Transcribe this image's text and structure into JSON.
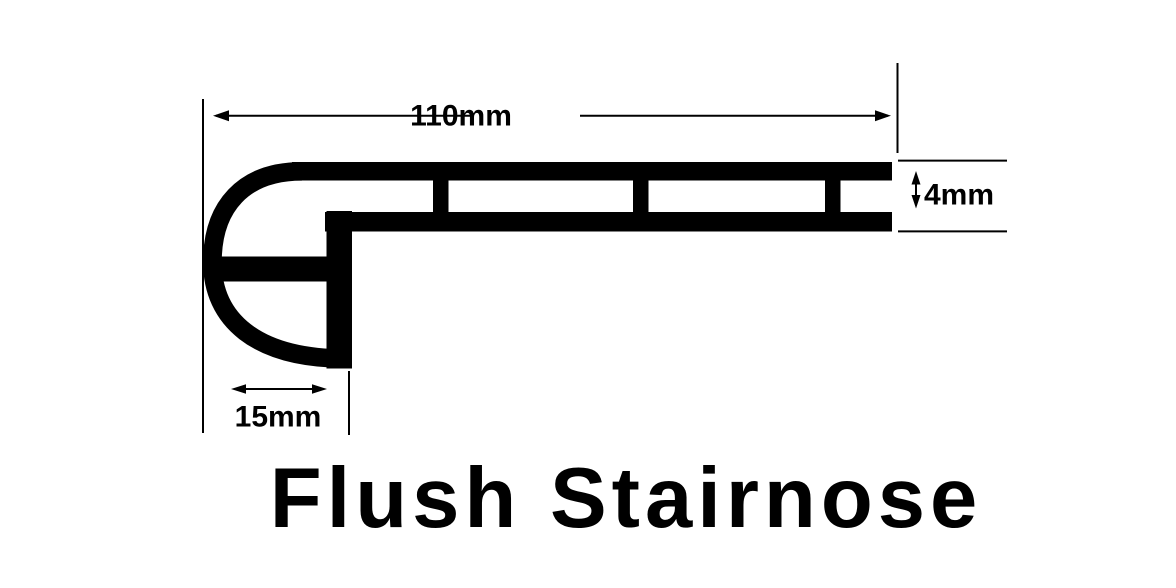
{
  "diagram": {
    "title": "Flush Stairnose",
    "ink_color": "#000000",
    "background_color": "#ffffff",
    "dimensions": {
      "width_label": "110mm",
      "thickness_label": "4mm",
      "nose_depth_label": "15mm"
    }
  }
}
